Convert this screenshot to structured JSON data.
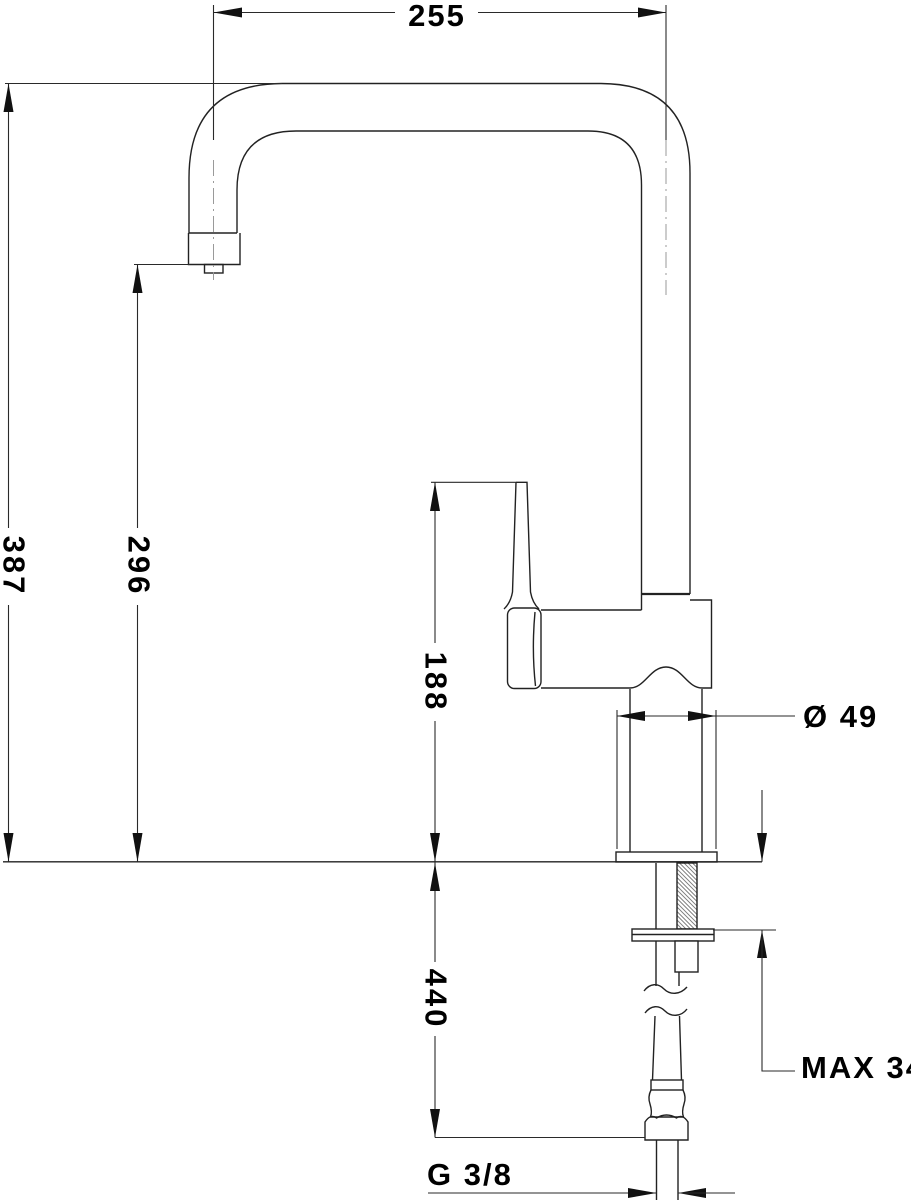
{
  "drawing": {
    "description": "Technical dimension drawing of a kitchen mixer tap (side view) with installation dimensions",
    "background": "#ffffff",
    "line_color": "#222222",
    "centerline_color": "#9a9a9a",
    "dimensions": {
      "spout_reach": "255",
      "overall_height": "387",
      "spout_outlet_height": "296",
      "body_height": "188",
      "hose_length": "440",
      "base_diameter": "Ø 49",
      "max_counter_thickness": "MAX 34",
      "thread_size": "G 3/8"
    }
  }
}
